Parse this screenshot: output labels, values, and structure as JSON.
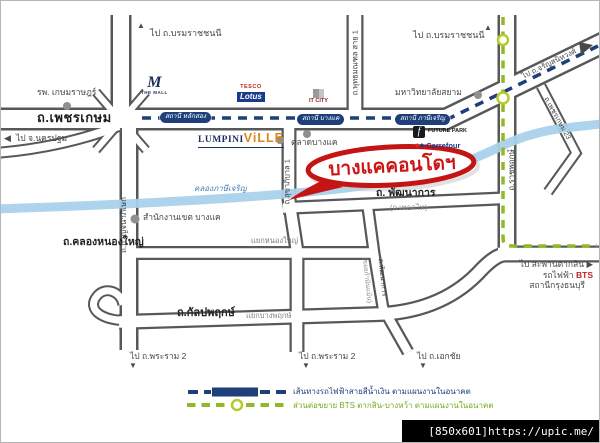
{
  "oval": {
    "text": "บางแคคอนโดฯ"
  },
  "roads": {
    "phetkasem": "ถ.เพชรเกษม",
    "kanchanaphisek": "ถ.กาญจนาภิเษก",
    "phutthamonthon": "ถ.พุทธมณฑล สาย 1",
    "ratchaphruek": "ถ.ราชพฤกษ์",
    "phetkasem23": "ถ.เพชรเกษม 23",
    "sukhaphiban1": "ถ.สุขาภิบาล 1",
    "phatthanakan": "ถ. พัฒนาการ",
    "thoetthai_alt": "(ถ.เทอดไท)",
    "kamnanmaen_main": "ถ.พัฒนาการ",
    "kamnanmaen_alt": "(ซอยกำนันแม้น)",
    "khlong_nong_yai": "ถ.คลองหนองใหญ่",
    "kanlapaphruek": "ถ.กัลปพฤกษ์"
  },
  "intersections": {
    "nong_yai": "แยกหนองใหญ่",
    "bang_phruek": "แยกบางพฤกษ์"
  },
  "directions": {
    "borom_left": "ไป ถ.บรมราชชนนี",
    "borom_right": "ไป ถ.บรมราชชนนี",
    "nakhon_pathom": "ไป จ.นครปฐม",
    "charansanitwong": "ไป ถ.จรัญสนิทวงศ์",
    "rama2_left": "ไป ถ.พระราม 2",
    "rama2_mid": "ไป ถ.พระราม 2",
    "ekachai": "ไป ถ.เอกชัย",
    "taksin_line1": "ไป สะพานตากสิน",
    "taksin_line2_prefix": "รถไฟฟ้า ",
    "taksin_bts": "BTS",
    "taksin_line3": "สถานีกรุงธนบุรี"
  },
  "places": {
    "hospital": "รพ. เกษมราษฎร์",
    "siam_university": "มหาวิทยาลัยสยาม",
    "market": "ตลาดบางแค",
    "district_office": "สำนักงานเขต บางแค",
    "canal": "คลองภาษีเจริญ"
  },
  "stations": {
    "lak_song": "สถานี หลักสอง",
    "bang_khae": "สถานี บางแค",
    "phasi_charoen": "สถานี ภาษีเจริญ"
  },
  "logos": {
    "the_mall_m": "M",
    "the_mall": "THE MALL",
    "tesco": "TESCO",
    "lotus": "Lotus",
    "it_city": "IT CITY",
    "lumpini": "LUMPINI",
    "ville": "ViLLE",
    "future_park_f": "f",
    "future_park": "FUTURE PARK",
    "carrefour": "Carrefour"
  },
  "legend": {
    "blue_line": "เส้นทางรถไฟฟ้าสายสีน้ำเงิน ตามแผนงานในอนาคต",
    "green_line": "ส่วนต่อขยาย BTS ตากสิน-บางหว้า ตามแผนงานในอนาคต"
  },
  "icons": {
    "arrow_up": "▲",
    "arrow_down": "▼",
    "arrow_left": "◀",
    "arrow_right": "▶"
  },
  "watermark": "[850x601]https://upic.me/",
  "colors": {
    "mrt_blue": "#1e3f7a",
    "bts_green": "#8fba25",
    "oval_red": "#c51414",
    "canal_blue": "#aad2ec",
    "road_casing": "#57585a"
  }
}
